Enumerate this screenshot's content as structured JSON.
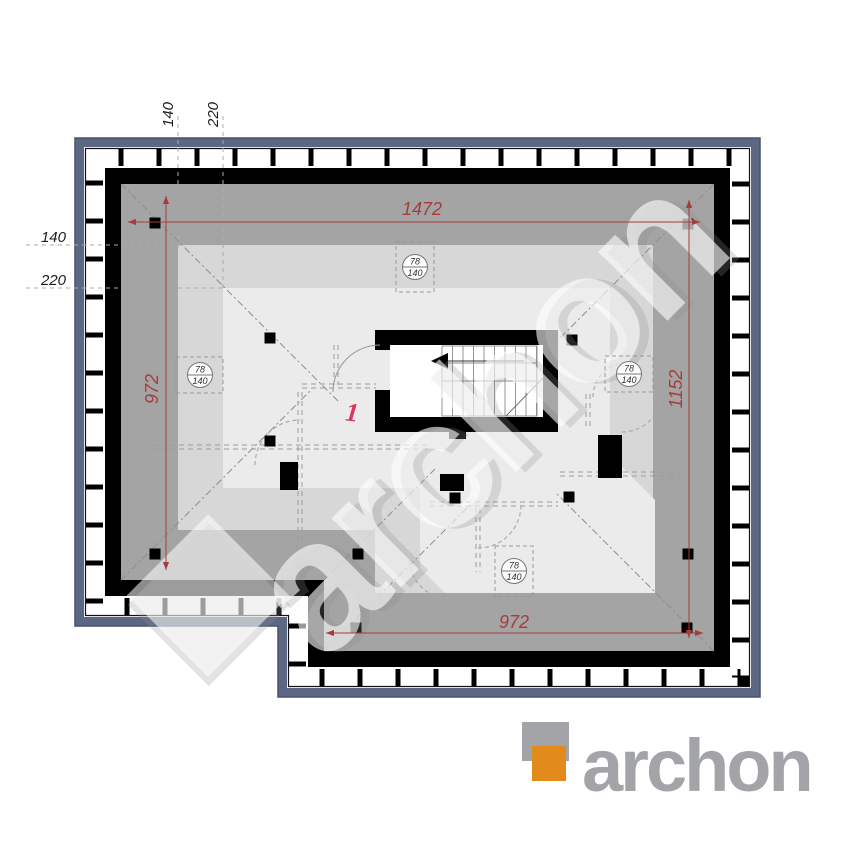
{
  "plan": {
    "dim_top": "1472",
    "dim_left": "972",
    "dim_right": "1152",
    "dim_bottom": "972",
    "height_line_low": "140",
    "height_line_high": "220",
    "room_number": "1",
    "roof_window": {
      "width": "78",
      "height": "140"
    }
  },
  "watermark": {
    "text": "archon"
  },
  "logo": {
    "text": "archon"
  },
  "colors": {
    "eaves_blue": "#5b6783",
    "roof_dark": "#a4a4a4",
    "roof_mid": "#d7d7d7",
    "roof_light": "#ebebeb",
    "dim_red": "#a63c3c",
    "room_red": "#d9385a",
    "logo_orange": "#e28a1c",
    "logo_gray": "#a2a4a7"
  }
}
